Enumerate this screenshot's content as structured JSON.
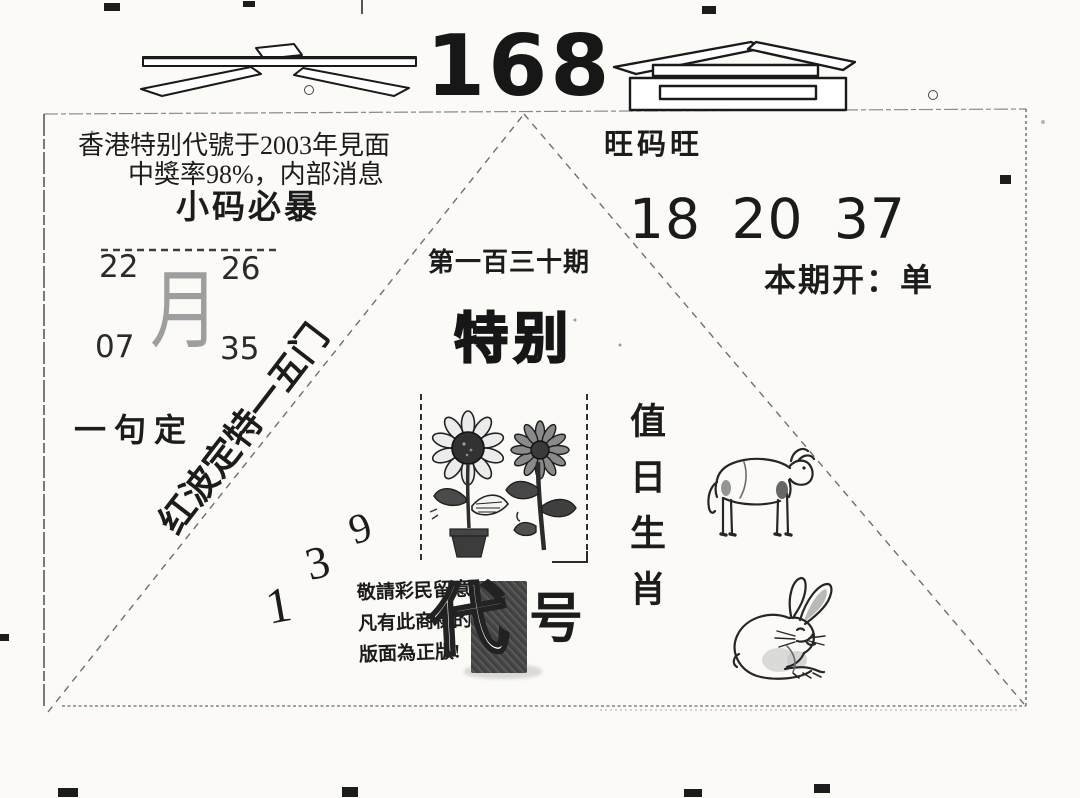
{
  "colors": {
    "paper": "#fbfaf6",
    "ink": "#1c1c1c",
    "faded_ink": "#9e9e9e",
    "stamp_dark": "#4a4a4a",
    "line_gray": "#6f6f6f"
  },
  "masthead": {
    "left_char": "六",
    "number": "168",
    "right_char": "會"
  },
  "promo": {
    "line1": "香港特别代號于2003年見面",
    "line2": "中獎率98%，内部消息",
    "line3": "小码必暴"
  },
  "month_block": {
    "char": "月",
    "top_left": "22",
    "top_right": "26",
    "bottom_left": "07",
    "bottom_right": "35"
  },
  "one_phrase": "一句定",
  "diagonal_tip": "红波定特一五门",
  "diagonal_numbers": {
    "n1": "1",
    "n2": "3",
    "n3": "9"
  },
  "issue": {
    "number_label": "第一百三十期",
    "special": "特别",
    "dai": "代",
    "hao": "号"
  },
  "notice": {
    "line1": "敬請彩民留意",
    "line2": "凡有此商標的",
    "line3": "版面為正版!"
  },
  "right_panel": {
    "wang": "旺码旺",
    "lucky_numbers": "18 20 37",
    "result": "本期开：单",
    "zodiac_title": "值日生肖"
  },
  "icons": {
    "potted_sunflower": "potted-sunflower-icon",
    "cut_sunflower": "cut-sunflower-icon",
    "ox": "ox-icon",
    "rabbit": "rabbit-icon",
    "seal": "ink-seal-stamp"
  }
}
